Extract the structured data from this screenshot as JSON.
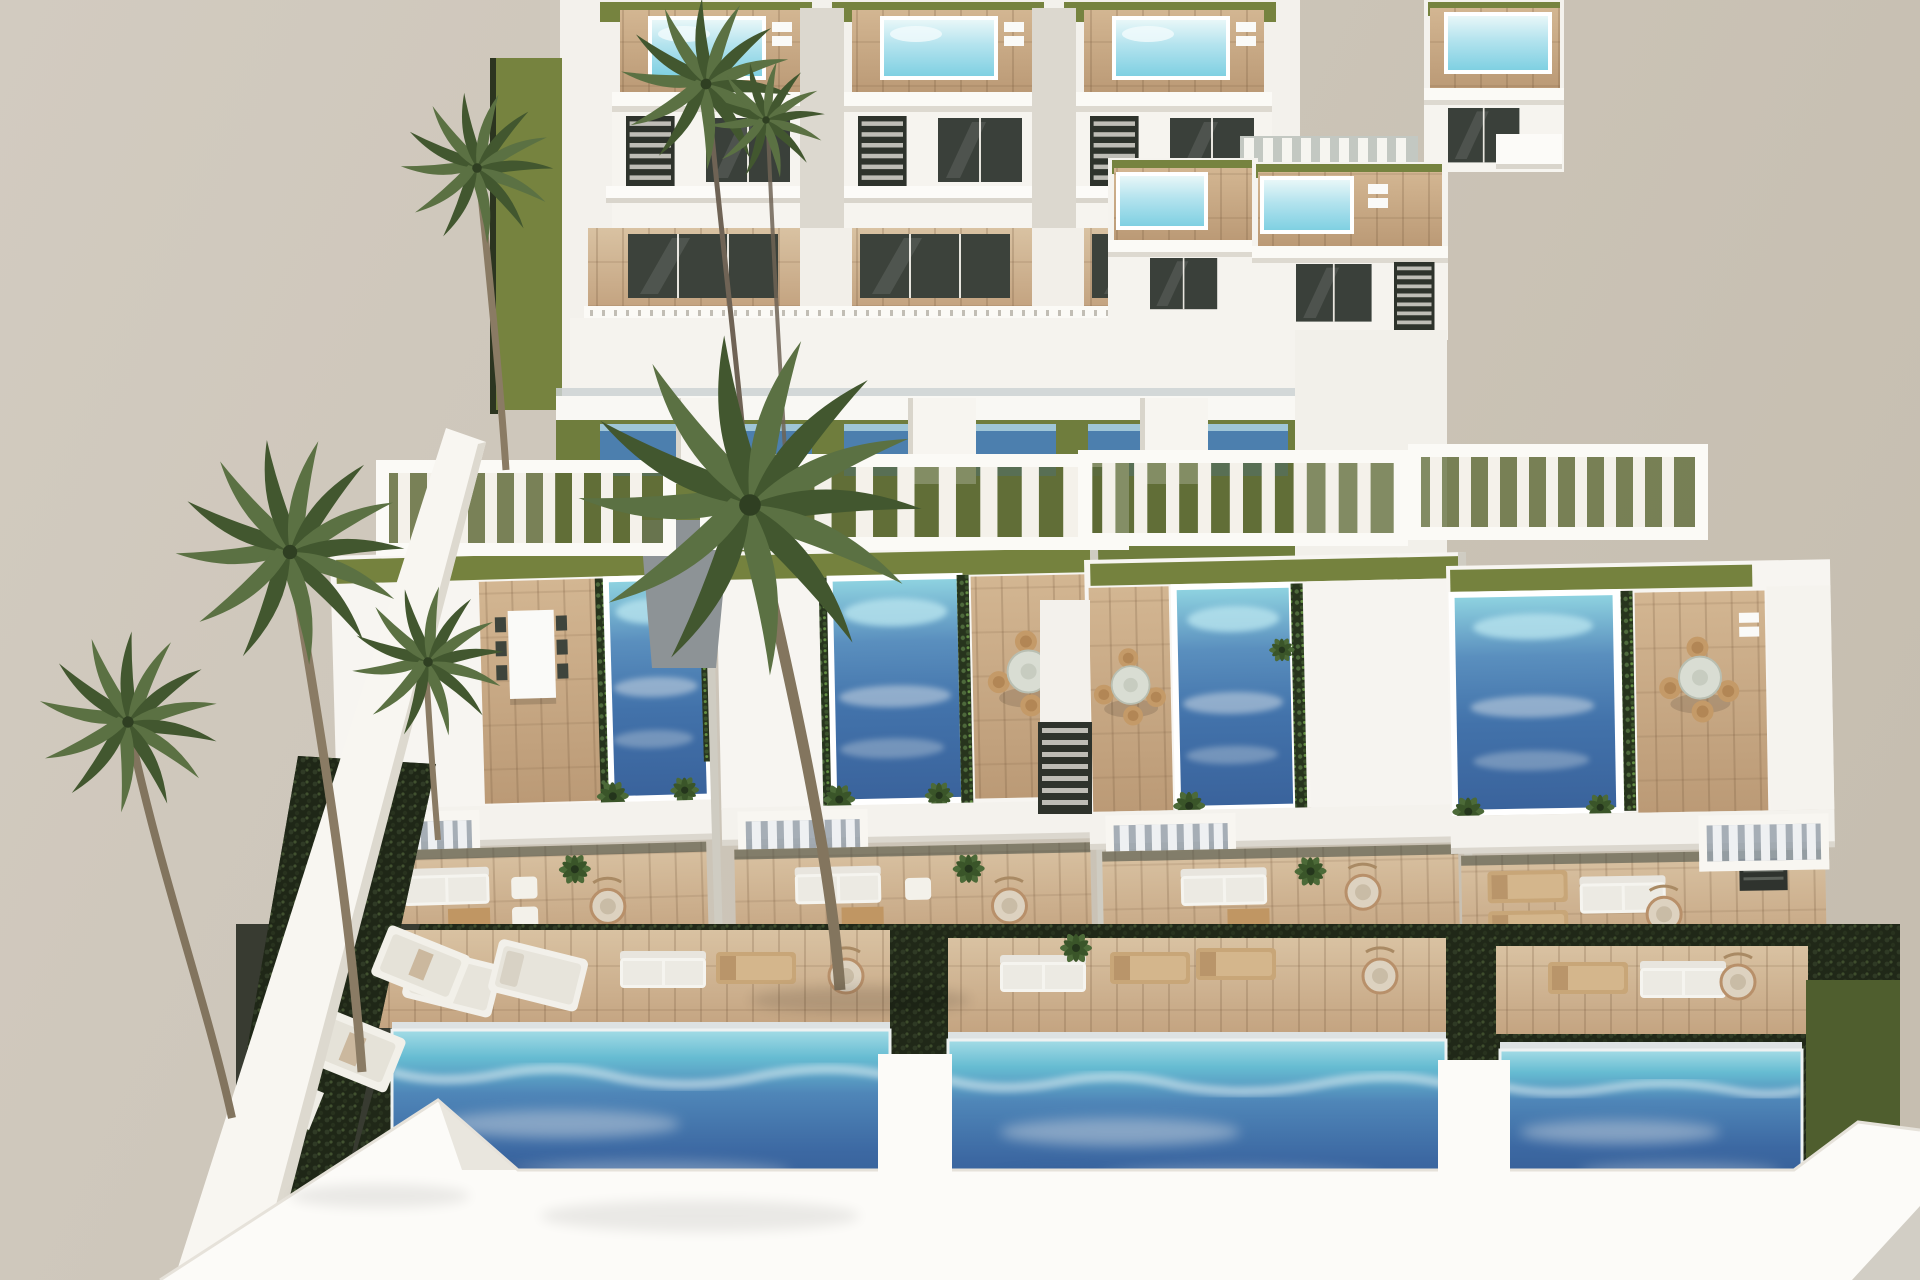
{
  "title": "Aerial 3D architectural render of a terraced white villa complex with private pools and palm trees",
  "scene": {
    "setting": "computer-generated real-estate visualization, high aerial viewpoint",
    "sky_color": "#cbc3b6",
    "back_row_villas": {
      "count": 3,
      "features": [
        "rooftop plunge pool",
        "sun deck",
        "artificial lawn",
        "glass facade",
        "external staircase",
        "balcony walkway"
      ]
    },
    "upper_right_villas": {
      "count": 3,
      "features": [
        "rooftop plunge pool",
        "wood deck",
        "slatted walkway"
      ]
    },
    "pergola_band": {
      "pergolas": 4,
      "color": "#ffffff"
    },
    "front_row_villas": {
      "count": 4,
      "features": [
        "large rooftop pool",
        "hedge planters",
        "dining terrace",
        "pergola",
        "lounge terrace",
        "slatted balcony"
      ]
    },
    "garden_level": {
      "pools": 3,
      "features": [
        "private pool",
        "turquoise shallow end",
        "sun loungers",
        "dark hedges",
        "lawn strips",
        "terrace furniture"
      ]
    },
    "palm_trees": 7,
    "palette": {
      "wall_white": "#f6f4ef",
      "wall_shadow": "#d9d5cc",
      "wood_deck": "#c9ac87",
      "wood_deck_light": "#d9c2a2",
      "lawn_olive": "#74813f",
      "hedge_dark": "#1f2717",
      "pool_deep_blue": "#3a659d",
      "pool_turquoise": "#7fcfe2",
      "pool_cyan_small": "#aee0ec",
      "pool_foam": "#dfeef2",
      "glass_dark": "#3c423b",
      "walkway_gray": "#8d9396",
      "palm_green": "#5b7143",
      "palm_green_dark": "#42572f",
      "trunk_brown": "#8a7b64"
    }
  }
}
